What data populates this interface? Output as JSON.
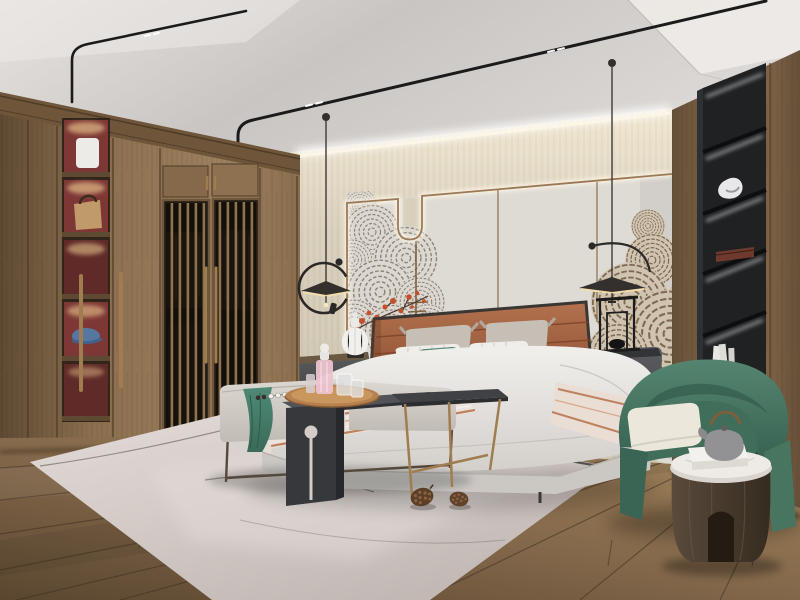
{
  "meta": {
    "type": "photoreal-interior-render",
    "room": "bedroom",
    "style": "modern chinese japandi"
  },
  "scene": {
    "description": "3D rendered modern Chinese style bedroom: wood wardrobe with lattice doors and lit display niches on the left, upholstered bed with terracotta leather headboard against a beige feature wall with wave-pattern mural and LED-outlined panels, two black disc pendant lamps, gray bench with dark side tables and a tray at the foot of the bed, pale rug with pine cones, green barrel armchair with a round wooden drum table and teapot on the right, black recessed shelving column in a walnut wall, wide-plank wood floor, ceiling with black magnetic track lights."
  },
  "objects": {
    "wardrobe": "wood wardrobe with lattice sliding doors and red-backed display niches",
    "niche_items": [
      "white folded linen",
      "tan handbag",
      "lit empty shelf",
      "blue cap",
      "dim shelf"
    ],
    "feature_wall": "beige panel wall with LED outline, bronze trim and wave mural with red blossoms",
    "pendant_left": "black disc pendant with C-ring arm",
    "pendant_right": "black disc pendant with arc arm",
    "bed": "upholstered bed, white duvet, striped throw, terracotta headboard",
    "pillows": [
      "gray pillow pair",
      "white striped pillows",
      "teal lumbar pillow",
      "terracotta bolster"
    ],
    "nightstand_left": "dark nightstand with white ribbed gourd lamp",
    "nightstand_right": "dark round nightstand with bronze handles and black frame lamp",
    "bench": "light gray bench with teal throw and bead garland",
    "c_table": "dark gray waterfall side table with round wood tray, pink perfume bottle and glasses",
    "small_table": "dark top side table with bronze legs",
    "rug": "pale pink-gray area rug with thin line pattern",
    "pine_cones": "two pine cones on the rug",
    "armchair": "green barrel armchair with cream cushion",
    "drum_table": "round dark wood drum table with marble top, white box and gray teapot",
    "shelf_column": "black recessed shelf column with LED strips, sculpture, wooden box and books",
    "ceiling": "light ceiling with black track lights and cove lighting",
    "floor": "wide plank wood floor"
  },
  "palette": {
    "ceilA": "#e7e3e0",
    "ceilB": "#c9c5c2",
    "ceilC": "#dedad7",
    "track": "#1b1b1b",
    "wallHi": "#f2e9d4",
    "wallMid": "#d8cfbc",
    "wallLo": "#cdc4b0",
    "wallGlow": "#fdf7e6",
    "panel": "#dedad4",
    "panelLine": "#9b7956",
    "panelDiv": "#8a6b4d",
    "muralGray": "#8d8476",
    "muralGrayBg": "#dcd7d1",
    "muralTan": "#7c6a52",
    "muralTanBg": "#d0c4b1",
    "blossom": "#c2512b",
    "branch": "#4a3a2e",
    "woodCrown": "#6f5539",
    "woodFace": "#8a6e4e",
    "woodHi": "#9c8060",
    "woodLo": "#5e4a33",
    "nicheRed": "#7d3836",
    "nicheRedDark": "#5f2a28",
    "spotGlow": "#ffdf9e",
    "latticeDark": "#241d15",
    "latticeSlat": "#8d7352",
    "litCloth": "#caa06a",
    "bronze": "#a07d50",
    "bronzeDark": "#7c5f3e",
    "rightWoodHi": "#8d6f4e",
    "rightWoodLo": "#66503a",
    "colBlack": "#1f2123",
    "colEdge": "#2e3134",
    "led": "#e9ebec",
    "floorHi": "#a0835a",
    "floorMid": "#82674a",
    "floorLo": "#5a4630",
    "seam": "#3f3122",
    "rug1": "#d5ccc8",
    "rug2": "#c2b9b5",
    "rugHi": "#e3dcd8",
    "rugLine": "#56504a",
    "duvetHi": "#f1efec",
    "duvetLo": "#d3cfcb",
    "bedBase": "#cbc8c4",
    "bedBaseLo": "#aeaaa6",
    "hb": "#b3724e",
    "hbLo": "#8a4f33",
    "frameDark": "#3a3633",
    "pGray": "#c6bfb6",
    "pWhite": "#efedea",
    "teal": "#4f8a76",
    "tealLo": "#3a6a58",
    "bolster": "#b06f4c",
    "bench": "#dcd7d1",
    "benchLo": "#c0bbb5",
    "metal": "#55493c",
    "tableTop": "#515358",
    "tableLo": "#36383b",
    "tray": "#b5824f",
    "trayIn": "#c9965e",
    "pink": "#ecc3d0",
    "chairHi": "#558570",
    "chairLo": "#34604f",
    "cream": "#ece7db",
    "drumHi": "#5a4b3b",
    "drumLo": "#352b20",
    "marble": "#eeeae5",
    "teapot": "#929294",
    "boxWhite": "#f3f1ed",
    "cordC": "#3c3a38",
    "discC": "#33302d",
    "warmRim": "#f6dfae"
  }
}
